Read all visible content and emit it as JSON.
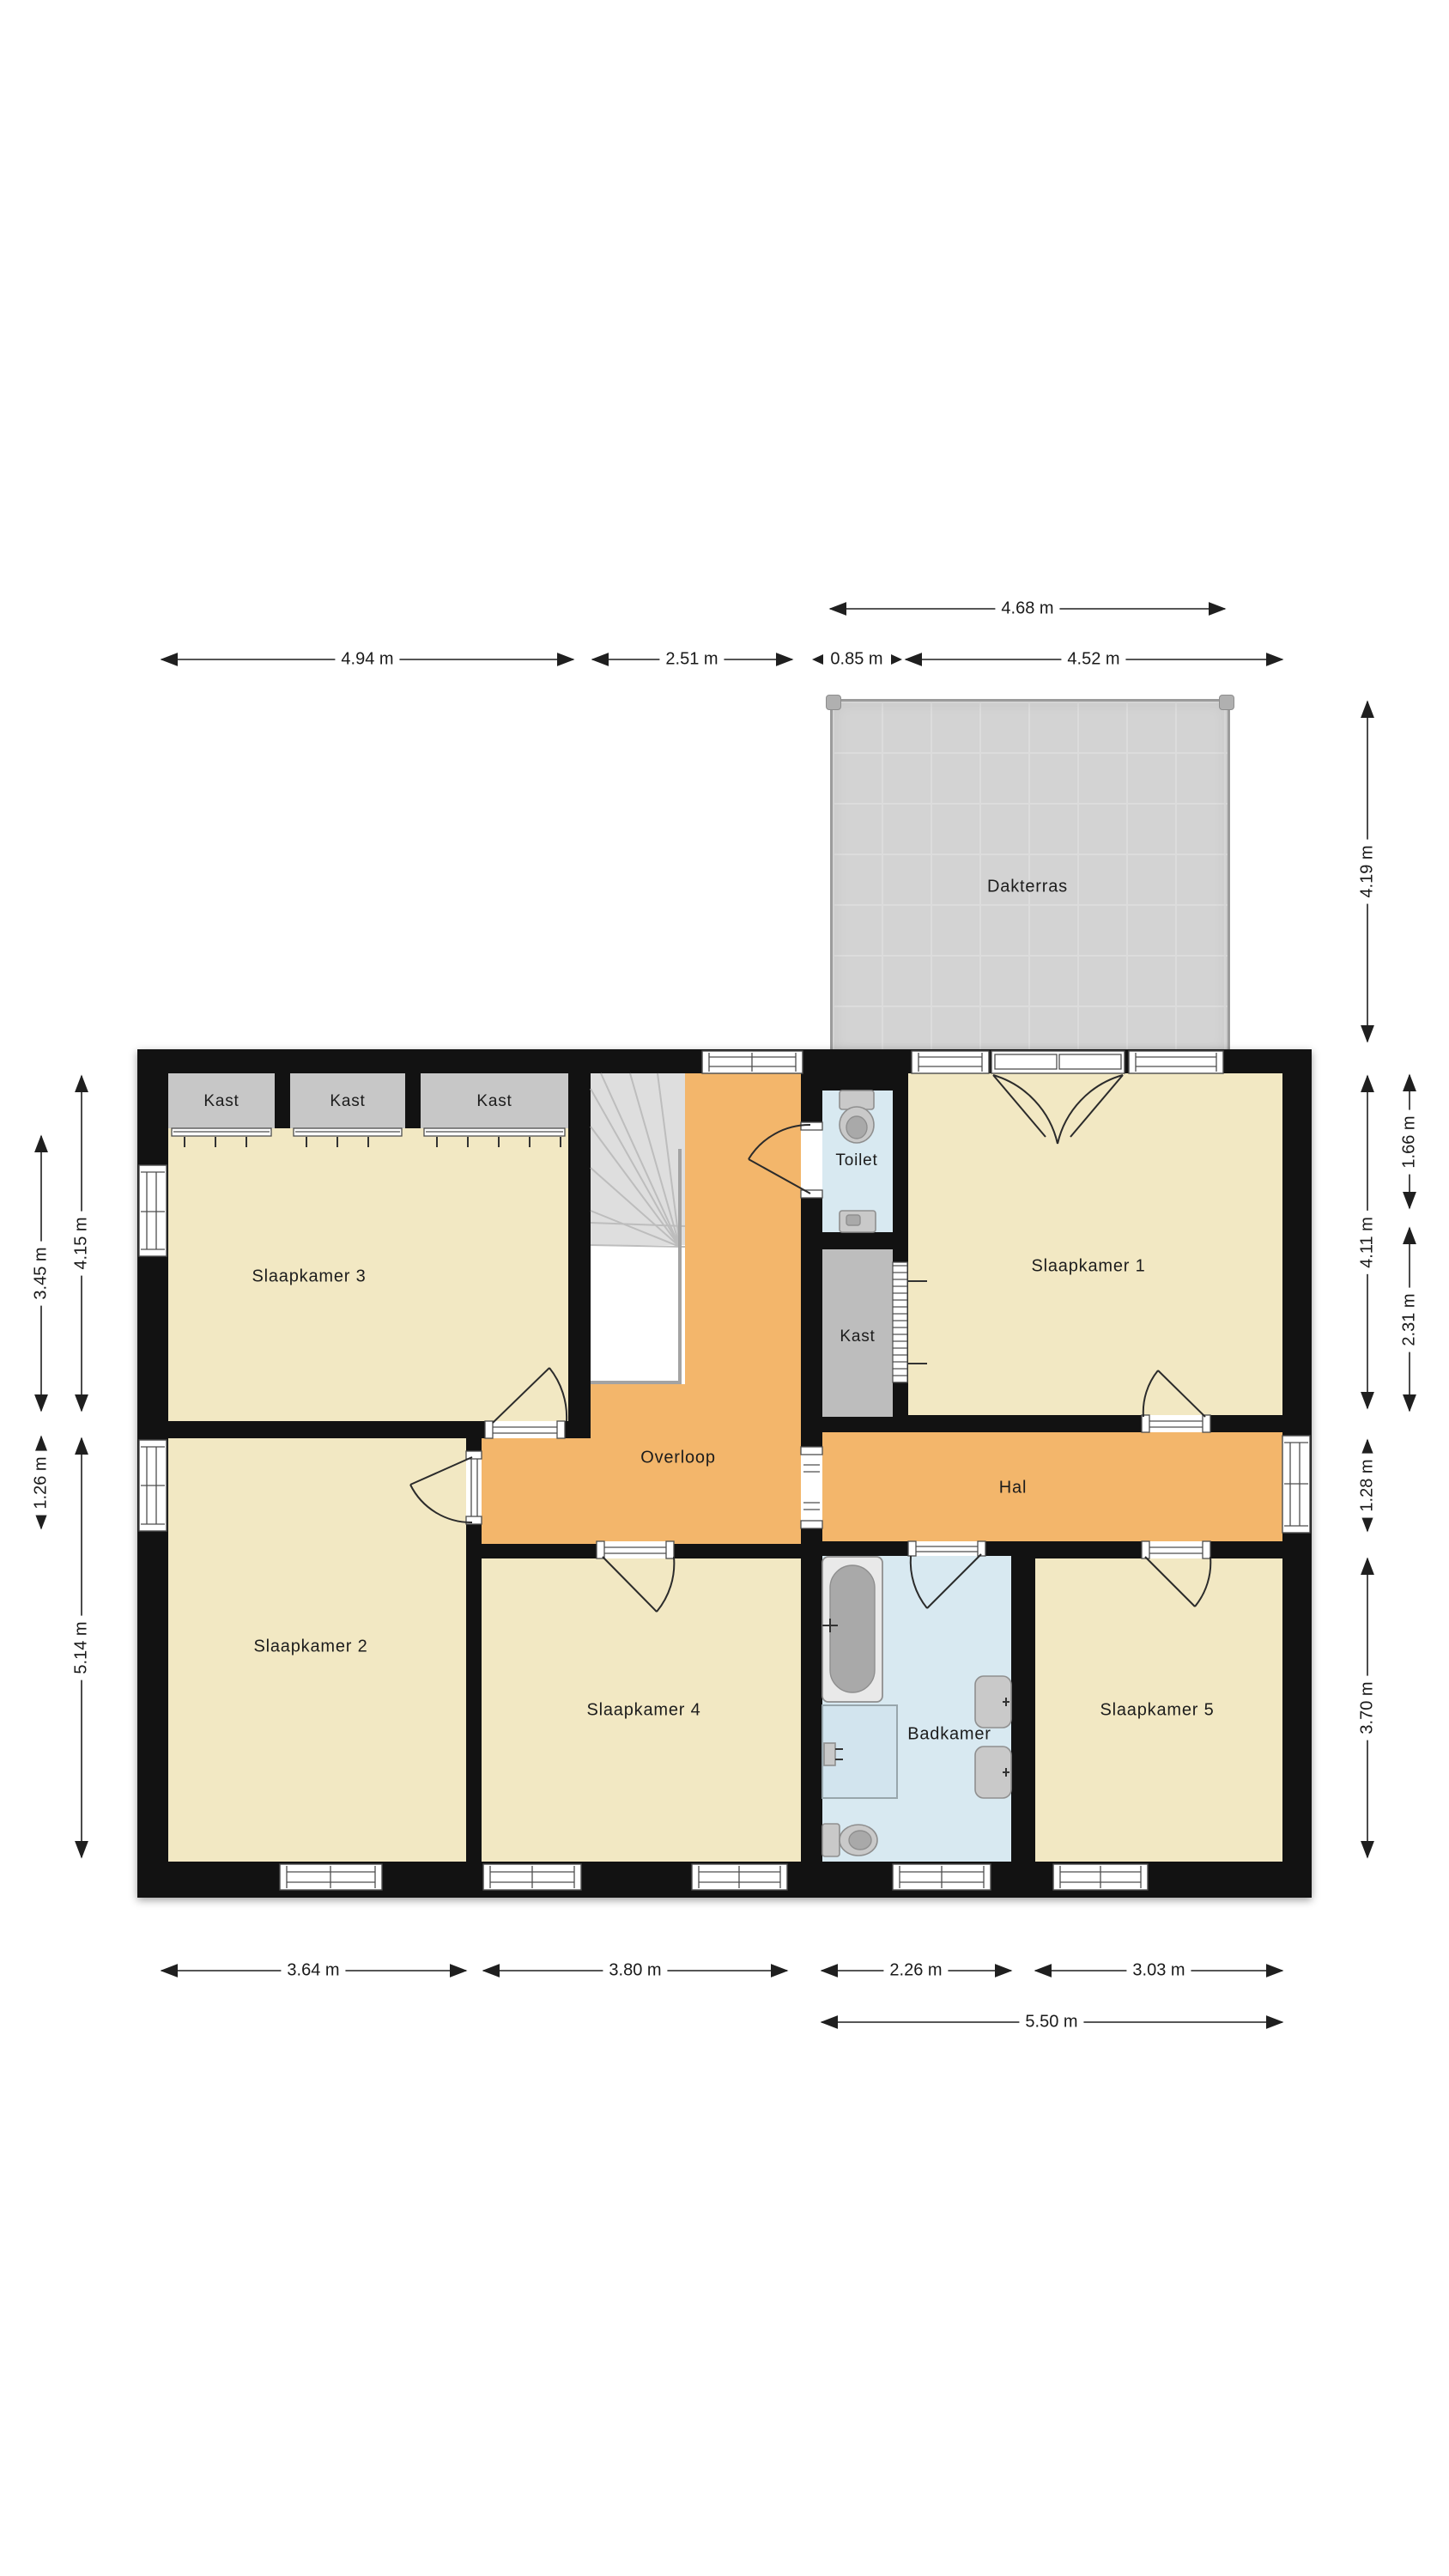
{
  "floorplan": {
    "rooms": {
      "dakterras": "Dakterras",
      "kast_1": "Kast",
      "kast_2": "Kast",
      "kast_3": "Kast",
      "slaapkamer_3": "Slaapkamer 3",
      "toilet": "Toilet",
      "slaapkamer_1": "Slaapkamer 1",
      "kast_middle": "Kast",
      "overloop": "Overloop",
      "hal": "Hal",
      "slaapkamer_2": "Slaapkamer 2",
      "slaapkamer_4": "Slaapkamer 4",
      "badkamer": "Badkamer",
      "slaapkamer_5": "Slaapkamer 5"
    },
    "dimensions": {
      "top": {
        "dakterras_width": "4.68 m",
        "west_wing_width": "4.94 m",
        "stair_zone_width": "2.51 m",
        "toilet_width": "0.85 m",
        "slaapkamer1_width": "4.52 m"
      },
      "bottom": {
        "slaapkamer2_width": "3.64 m",
        "slaapkamer4_width": "3.80 m",
        "badkamer_width": "2.26 m",
        "slaapkamer5_width": "3.03 m",
        "southeast_total_width": "5.50 m"
      },
      "left": {
        "slaapkamer3_height": "3.45 m",
        "northwest_height": "4.15 m",
        "window_segment_height": "1.26 m",
        "slaapkamer2_height": "5.14 m"
      },
      "right": {
        "dakterras_height": "4.19 m",
        "slaapkamer1_height": "4.11 m",
        "upper_segment": "1.66 m",
        "lower_segment": "2.31 m",
        "hal_height": "1.28 m",
        "south_row_height": "3.70 m"
      }
    },
    "colors": {
      "wall": "#121212",
      "bedroom_floor": "#f2e8c3",
      "hall_floor": "#f3b66b",
      "bathroom_floor": "#d8e9f1",
      "closet_floor": "#c7c7c7",
      "terrace_floor": "#d3d3d3",
      "background": "#ffffff"
    }
  }
}
